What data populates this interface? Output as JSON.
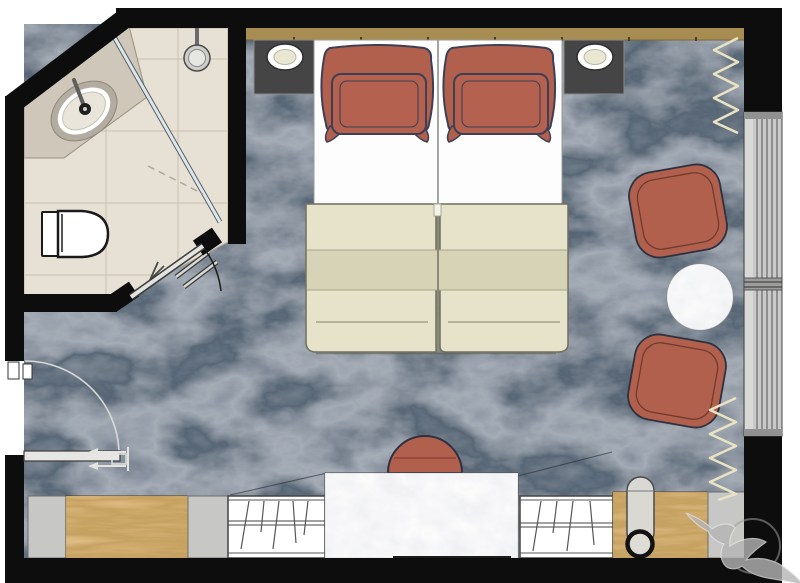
{
  "palette": {
    "wall": "#0d0d0d",
    "carpet": "#46515c",
    "tile": "#e7e0d4",
    "tile_line": "#c9c1b2",
    "counter": "#cfc7ba",
    "fixture_white": "#ffffff",
    "headboard": "#a78d52",
    "wood": "#b5843f",
    "terracotta": "#b2604e",
    "pillow_outline": "#3d4055",
    "duvet": "#e6e3ca",
    "duvet_band": "#d6d3b7",
    "mattress": "#fdfdfd",
    "nightstand": "#454545",
    "lamp_cream": "#e9e6d2",
    "window_frame": "#c9c9c9",
    "curtain": "#e9e3c4",
    "marble": "#f1f1ef",
    "panel_grey": "#c7c7c5",
    "glass": "#dfe6e8",
    "watermark": "#b5b5b5"
  },
  "plan": {
    "type": "hotel-room-floor-plan",
    "bathroom": {
      "name": "bathroom",
      "fixtures": [
        "vanity-counter",
        "sink",
        "faucet",
        "shower-head",
        "shower-glass-screen",
        "toilet",
        "towel-rail",
        "robe-hook",
        "bathroom-door"
      ]
    },
    "bedroom": {
      "name": "bedroom",
      "furniture": [
        "headboard",
        "twin-bed-left",
        "twin-bed-right",
        "pillows",
        "duvet",
        "nightstand-left",
        "nightstand-right",
        "table-lamp-left",
        "table-lamp-right",
        "lounge-chair-upper",
        "lounge-chair-lower",
        "round-side-table",
        "desk",
        "desk-chair",
        "wardrobe-left",
        "wardrobe-right",
        "wood-cabinet-left",
        "wood-cabinet-right",
        "grey-panels",
        "floor-lamp",
        "luggage-rack",
        "curtain-upper",
        "curtain-lower",
        "window",
        "entry-door"
      ]
    },
    "watermark": "hummingbird-logo"
  }
}
